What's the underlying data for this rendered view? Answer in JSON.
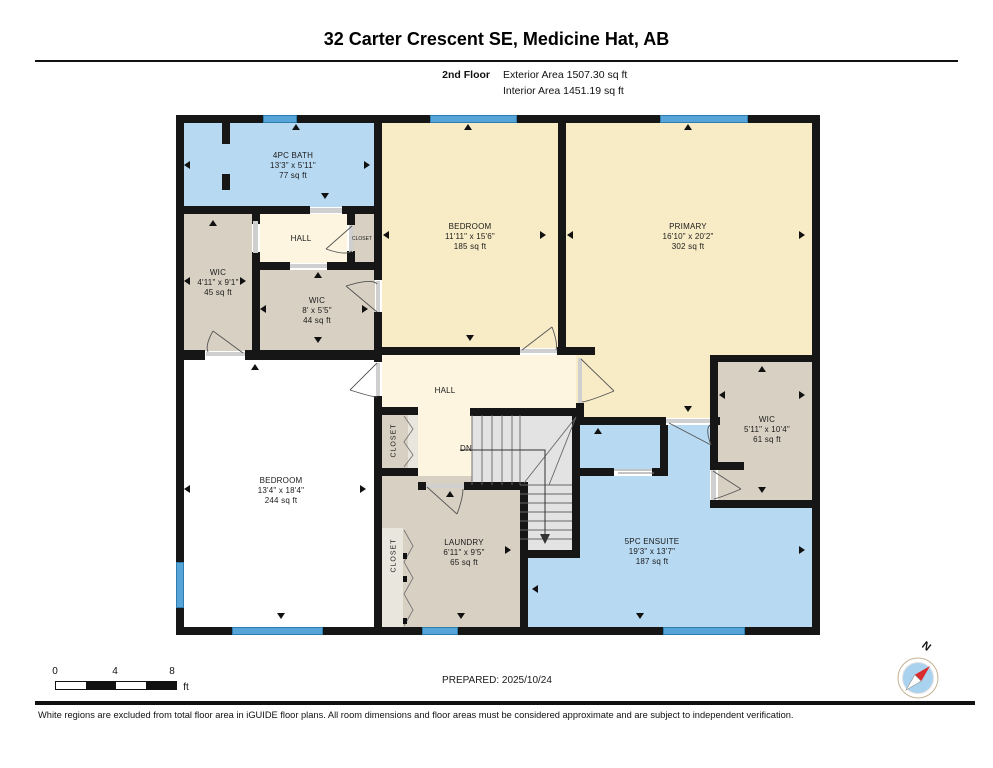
{
  "header": {
    "title": "32 Carter Crescent SE, Medicine Hat, AB",
    "floor_label": "2nd Floor",
    "exterior_area": "Exterior Area 1507.30 sq ft",
    "interior_area": "Interior Area 1451.19 sq ft"
  },
  "rooms": [
    {
      "name": "4PC BATH",
      "dims": "13'3\" x 5'11\"",
      "area": "77 sq ft"
    },
    {
      "name": "HALL"
    },
    {
      "name": "CLOSET"
    },
    {
      "name": "WIC",
      "dims": "4'11\" x 9'1\"",
      "area": "45 sq ft"
    },
    {
      "name": "WIC",
      "dims": "8' x 5'5\"",
      "area": "44 sq ft"
    },
    {
      "name": "BEDROOM",
      "dims": "11'11\" x 15'6\"",
      "area": "185 sq ft"
    },
    {
      "name": "PRIMARY",
      "dims": "16'10\" x 20'2\"",
      "area": "302 sq ft"
    },
    {
      "name": "BEDROOM",
      "dims": "13'4\" x 18'4\"",
      "area": "244 sq ft"
    },
    {
      "name": "HALL"
    },
    {
      "name": "CLOSET"
    },
    {
      "name": "CLOSET"
    },
    {
      "name": "DN"
    },
    {
      "name": "LAUNDRY",
      "dims": "6'11\" x 9'5\"",
      "area": "65 sq ft"
    },
    {
      "name": "5PC ENSUITE",
      "dims": "19'3\" x 13'7\"",
      "area": "187 sq ft"
    },
    {
      "name": "WIC",
      "dims": "5'11\" x 10'4\"",
      "area": "61 sq ft"
    }
  ],
  "footer": {
    "scale": {
      "t0": "0",
      "t4": "4",
      "t8": "8",
      "unit": "ft"
    },
    "prepared": "PREPARED: 2025/10/24",
    "compass_n": "N",
    "disclaimer": "White regions are excluded from total floor area in iGUIDE floor plans. All room dimensions and floor areas must be considered approximate and are subject to independent verification."
  },
  "colors": {
    "wall": "#161616",
    "room_cream": "#f8ecc6",
    "hall_cream": "#fdf5e0",
    "room_blue": "#b7d9f2",
    "room_gray": "#d8d0c3",
    "window_blue": "#57a5d8",
    "stairs_gray": "#e3e3e3",
    "compass_needle_red": "#d92b2b",
    "compass_disc_blue": "#a9d2ef"
  }
}
